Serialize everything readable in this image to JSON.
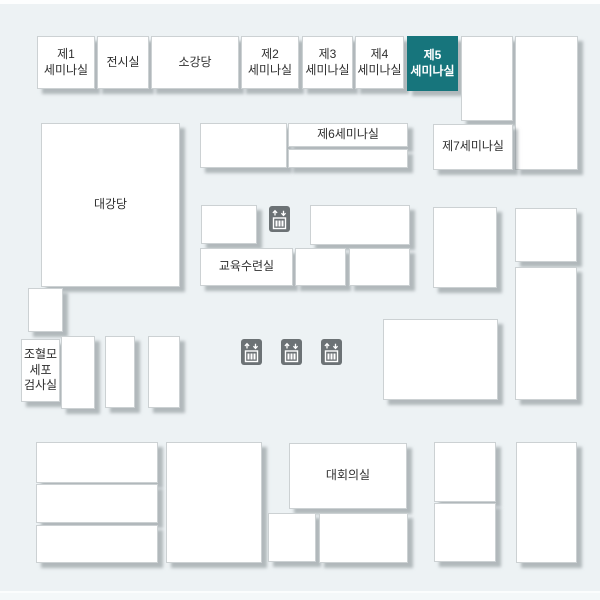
{
  "palette": {
    "background": "#edf2f4",
    "box_fill": "#ffffff",
    "box_border": "#ccd1d3",
    "shadow": "rgba(128,137,141,0.55)",
    "highlight_fill": "#17757c",
    "highlight_text": "#ffffff",
    "text": "#2f2f2f",
    "elevator_fill": "#6c7275",
    "elevator_glyph": "#ffffff",
    "top_strip": "#fdfefe",
    "bottom_strip": "#f4f8f9"
  },
  "canvas": {
    "width": 600,
    "height": 600
  },
  "rooms": [
    {
      "id": "seminar-1",
      "label": "제1\n세미나실",
      "x": 37,
      "y": 36,
      "w": 58,
      "h": 53
    },
    {
      "id": "exhibition-hall",
      "label": "전시실",
      "x": 97,
      "y": 36,
      "w": 52,
      "h": 53
    },
    {
      "id": "small-auditorium",
      "label": "소강당",
      "x": 151,
      "y": 36,
      "w": 88,
      "h": 53
    },
    {
      "id": "seminar-2",
      "label": "제2\n세미나실",
      "x": 241,
      "y": 36,
      "w": 58,
      "h": 53
    },
    {
      "id": "seminar-3",
      "label": "제3\n세미나실",
      "x": 302,
      "y": 36,
      "w": 51,
      "h": 53
    },
    {
      "id": "seminar-4",
      "label": "제4\n세미나실",
      "x": 355,
      "y": 36,
      "w": 49,
      "h": 53
    },
    {
      "id": "seminar-5",
      "label": "제5\n세미나실",
      "x": 407,
      "y": 36,
      "w": 51,
      "h": 55,
      "highlight": true
    },
    {
      "id": "blank-a1",
      "label": "",
      "x": 461,
      "y": 36,
      "w": 52,
      "h": 85
    },
    {
      "id": "blank-a2",
      "label": "",
      "x": 515,
      "y": 36,
      "w": 63,
      "h": 134
    },
    {
      "id": "blank-b1",
      "label": "",
      "x": 200,
      "y": 123,
      "w": 87,
      "h": 45
    },
    {
      "id": "seminar-6",
      "label": "제6세미나실",
      "x": 288,
      "y": 123,
      "w": 120,
      "h": 24
    },
    {
      "id": "blank-b2",
      "label": "",
      "x": 288,
      "y": 149,
      "w": 120,
      "h": 19
    },
    {
      "id": "seminar-7",
      "label": "제7세미나실",
      "x": 433,
      "y": 124,
      "w": 80,
      "h": 46
    },
    {
      "id": "grand-auditorium",
      "label": "대강당",
      "x": 41,
      "y": 123,
      "w": 139,
      "h": 164
    },
    {
      "id": "blank-c1",
      "label": "",
      "x": 201,
      "y": 205,
      "w": 56,
      "h": 39
    },
    {
      "id": "blank-c2",
      "label": "",
      "x": 310,
      "y": 205,
      "w": 100,
      "h": 40
    },
    {
      "id": "education-training-room",
      "label": "교육수련실",
      "x": 200,
      "y": 248,
      "w": 93,
      "h": 38
    },
    {
      "id": "blank-c3",
      "label": "",
      "x": 295,
      "y": 248,
      "w": 51,
      "h": 38
    },
    {
      "id": "blank-c4",
      "label": "",
      "x": 349,
      "y": 248,
      "w": 61,
      "h": 38
    },
    {
      "id": "blank-d1",
      "label": "",
      "x": 433,
      "y": 207,
      "w": 64,
      "h": 81
    },
    {
      "id": "blank-e1",
      "label": "",
      "x": 515,
      "y": 208,
      "w": 62,
      "h": 54
    },
    {
      "id": "blank-e2",
      "label": "",
      "x": 515,
      "y": 267,
      "w": 62,
      "h": 133
    },
    {
      "id": "blank-f1",
      "label": "",
      "x": 28,
      "y": 288,
      "w": 35,
      "h": 44
    },
    {
      "id": "stem-cell-lab",
      "label": "조혈모\n세포\n검사실",
      "x": 21,
      "y": 339,
      "w": 39,
      "h": 63
    },
    {
      "id": "blank-g1",
      "label": "",
      "x": 61,
      "y": 336,
      "w": 34,
      "h": 73
    },
    {
      "id": "blank-g2",
      "label": "",
      "x": 105,
      "y": 336,
      "w": 30,
      "h": 72
    },
    {
      "id": "blank-g3",
      "label": "",
      "x": 148,
      "y": 336,
      "w": 32,
      "h": 72
    },
    {
      "id": "blank-h1",
      "label": "",
      "x": 383,
      "y": 319,
      "w": 115,
      "h": 81
    },
    {
      "id": "blank-i1",
      "label": "",
      "x": 36,
      "y": 442,
      "w": 122,
      "h": 41
    },
    {
      "id": "blank-i2",
      "label": "",
      "x": 36,
      "y": 484,
      "w": 122,
      "h": 39
    },
    {
      "id": "blank-i3",
      "label": "",
      "x": 36,
      "y": 525,
      "w": 122,
      "h": 38
    },
    {
      "id": "blank-j1",
      "label": "",
      "x": 166,
      "y": 442,
      "w": 96,
      "h": 121
    },
    {
      "id": "conference-room",
      "label": "대회의실",
      "x": 289,
      "y": 443,
      "w": 118,
      "h": 66
    },
    {
      "id": "blank-k1",
      "label": "",
      "x": 268,
      "y": 513,
      "w": 48,
      "h": 49
    },
    {
      "id": "blank-k2",
      "label": "",
      "x": 319,
      "y": 513,
      "w": 89,
      "h": 50
    },
    {
      "id": "blank-l1",
      "label": "",
      "x": 434,
      "y": 442,
      "w": 62,
      "h": 60
    },
    {
      "id": "blank-l2",
      "label": "",
      "x": 434,
      "y": 503,
      "w": 62,
      "h": 59
    },
    {
      "id": "blank-l3",
      "label": "",
      "x": 516,
      "y": 442,
      "w": 61,
      "h": 121
    }
  ],
  "elevators": [
    {
      "x": 269,
      "y": 206
    },
    {
      "x": 241,
      "y": 339
    },
    {
      "x": 281,
      "y": 339
    },
    {
      "x": 321,
      "y": 339
    }
  ]
}
